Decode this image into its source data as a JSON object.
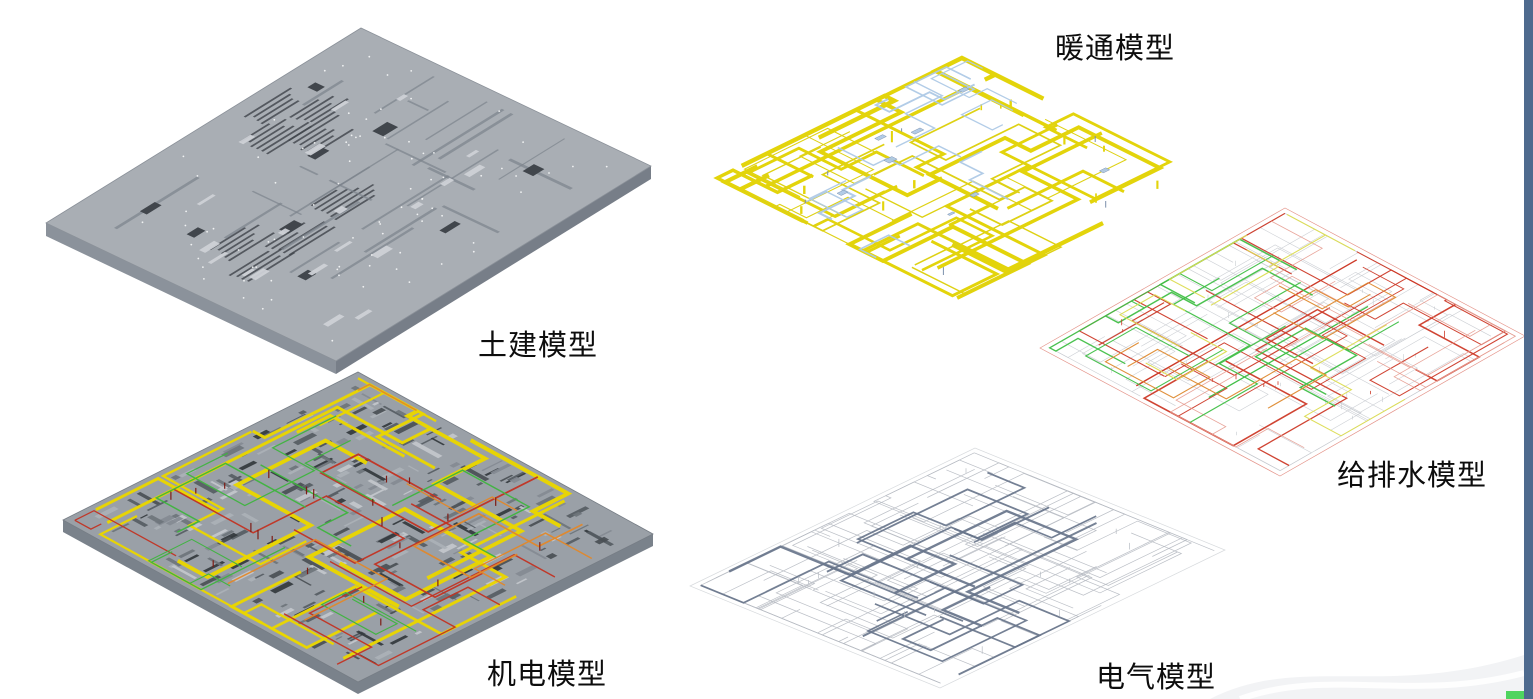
{
  "page": {
    "background": "#ffffff"
  },
  "figures": {
    "civil": {
      "label": "土建模型",
      "palette": {
        "slab": "#a9aeb4",
        "slab_edge": "#8b9199",
        "side_mid": "#8b929b",
        "side_dark": "#777e88",
        "detail_dark": "#41464c",
        "detail_mid": "#7c838b",
        "detail_light": "#cdd1d6",
        "dot": "#f8f9fa"
      }
    },
    "mep": {
      "label": "机电模型",
      "palette": {
        "deck": "#9aa0a7",
        "deck_edge": "#767d85",
        "side": "#7a828b",
        "clutter": [
          "#565c63",
          "#6e747b",
          "#848a92",
          "#c3c7cc",
          "#4a4f55",
          "#abb1b7",
          "#33383d"
        ],
        "pipe_yellow": "#e9d600",
        "pipe_red": "#c23322",
        "pipe_green": "#3eb43e",
        "pipe_orange": "#e2882a",
        "tick_dark_red": "#7e1b14"
      }
    },
    "hvac": {
      "label": "暖通模型",
      "palette": {
        "duct_yellow": "#e3d40b",
        "duct_yellow_thin": "#ded114",
        "fitting_blue": "#aec9e6",
        "fitting_slate": "#7b90ab"
      }
    },
    "plumbing": {
      "label": "给排水模型",
      "palette": {
        "frame_gray": "#c6cacf",
        "red": "#cd3a28",
        "salmon": "#e59a8e",
        "green": "#41bf47",
        "yellow": "#dcdc52",
        "orange": "#de8a30"
      }
    },
    "electrical": {
      "label": "电气模型",
      "palette": {
        "wire_light": "#b7bcc3",
        "wire_dark": "#68758b",
        "outline": "#c6cacf"
      }
    }
  },
  "window": {
    "edge_bar_color": "#4e6a8e",
    "corner_accent_color": "#4fd45f",
    "swoosh_color": "#f2f3f5"
  }
}
